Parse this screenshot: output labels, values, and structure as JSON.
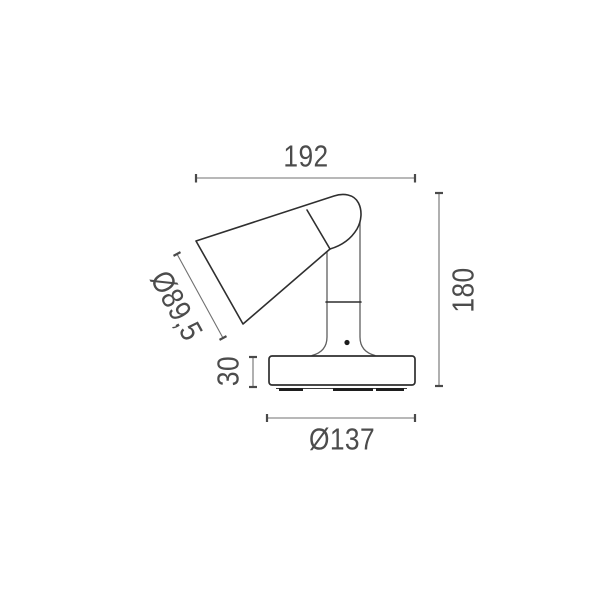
{
  "drawing": {
    "kind": "technical-dimension-drawing",
    "view": "lamp-side-view",
    "dimensions": {
      "overall_width": "192",
      "overall_height": "180",
      "shade_diameter": "Ø89,5",
      "base_height": "30",
      "base_diameter": "Ø137"
    },
    "colors": {
      "background": "#ffffff",
      "outline": "#2f2f2f",
      "dimension_line": "#707070",
      "label_text": "#4c4c4c"
    }
  }
}
